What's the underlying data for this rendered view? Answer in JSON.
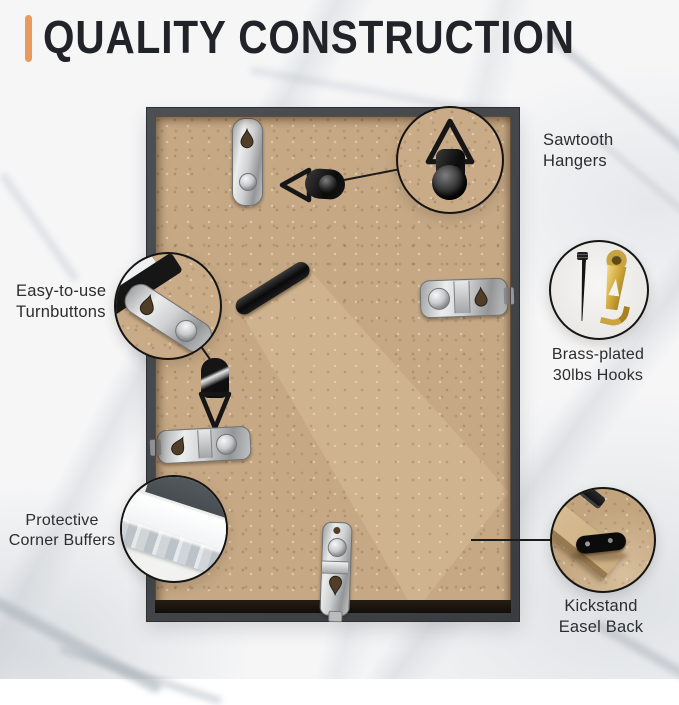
{
  "header": {
    "title": "QUALITY CONSTRUCTION"
  },
  "callouts": {
    "sawtooth": {
      "label": "Sawtooth Hangers"
    },
    "turnbuttons": {
      "line1": "Easy-to-use",
      "line2": "Turnbuttons"
    },
    "hooks": {
      "line1": "Brass-plated",
      "line2": "30lbs Hooks"
    },
    "buffers": {
      "line1": "Protective",
      "line2": "Corner Buffers"
    },
    "kickstand": {
      "line1": "Kickstand",
      "line2": "Easel Back"
    }
  },
  "colors": {
    "accent_bar": "#E9995C",
    "title_text": "#212329",
    "label_text": "#2D2D2E",
    "frame_border": "#3E4246",
    "mdf_board": "#C6A884",
    "brass_hook": "#C9A43E",
    "marble_background": "#F6F6F7"
  }
}
